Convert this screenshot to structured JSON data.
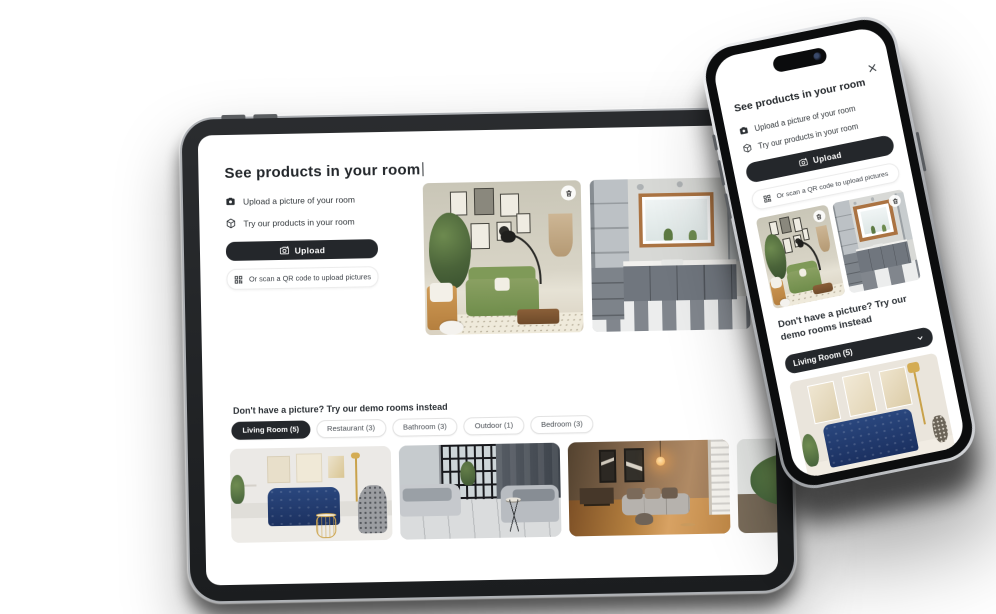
{
  "colors": {
    "button_dark": "#24272b",
    "text_primary": "#2d3237",
    "text_secondary": "#4a4f55",
    "tab_active_bg": "#24272b",
    "tab_active_text": "#ffffff",
    "tab_border": "#e2e2e2",
    "screen_bg": "#ffffff",
    "bezel": "#1d1f21"
  },
  "modal": {
    "title": "See products in your room",
    "features": [
      {
        "icon": "camera-icon",
        "label": "Upload a picture of your room"
      },
      {
        "icon": "cube-icon",
        "label": "Try our products in your room"
      }
    ],
    "upload_button": {
      "icon": "camera-plus-icon",
      "label": "Upload"
    },
    "qr_button": {
      "icon": "qr-code-icon",
      "label": "Or scan a QR code to upload pictures"
    },
    "demo_heading": "Don't have a picture? Try our demo rooms instead"
  },
  "tablet": {
    "tabs": [
      {
        "label": "Living Room (5)",
        "active": true
      },
      {
        "label": "Restaurant (3)",
        "active": false
      },
      {
        "label": "Bathroom (3)",
        "active": false
      },
      {
        "label": "Outdoor (1)",
        "active": false
      },
      {
        "label": "Bedroom (3)",
        "active": false
      }
    ],
    "uploaded_images": [
      {
        "name": "living-room-green-sofa-gallery-wall"
      },
      {
        "name": "kitchen-grey-cabinets-striped-floor"
      }
    ],
    "demo_images": [
      {
        "name": "living-room-navy-sofa"
      },
      {
        "name": "living-room-grey-sectional"
      },
      {
        "name": "living-room-warm-wood"
      },
      {
        "name": "hallway-potted-plant"
      }
    ]
  },
  "phone": {
    "close_icon": "x-icon",
    "dropdown": {
      "value": "Living Room (5)",
      "icon": "chevron-down-icon"
    },
    "demo_image": {
      "name": "living-room-navy-velvet-sofa"
    }
  }
}
